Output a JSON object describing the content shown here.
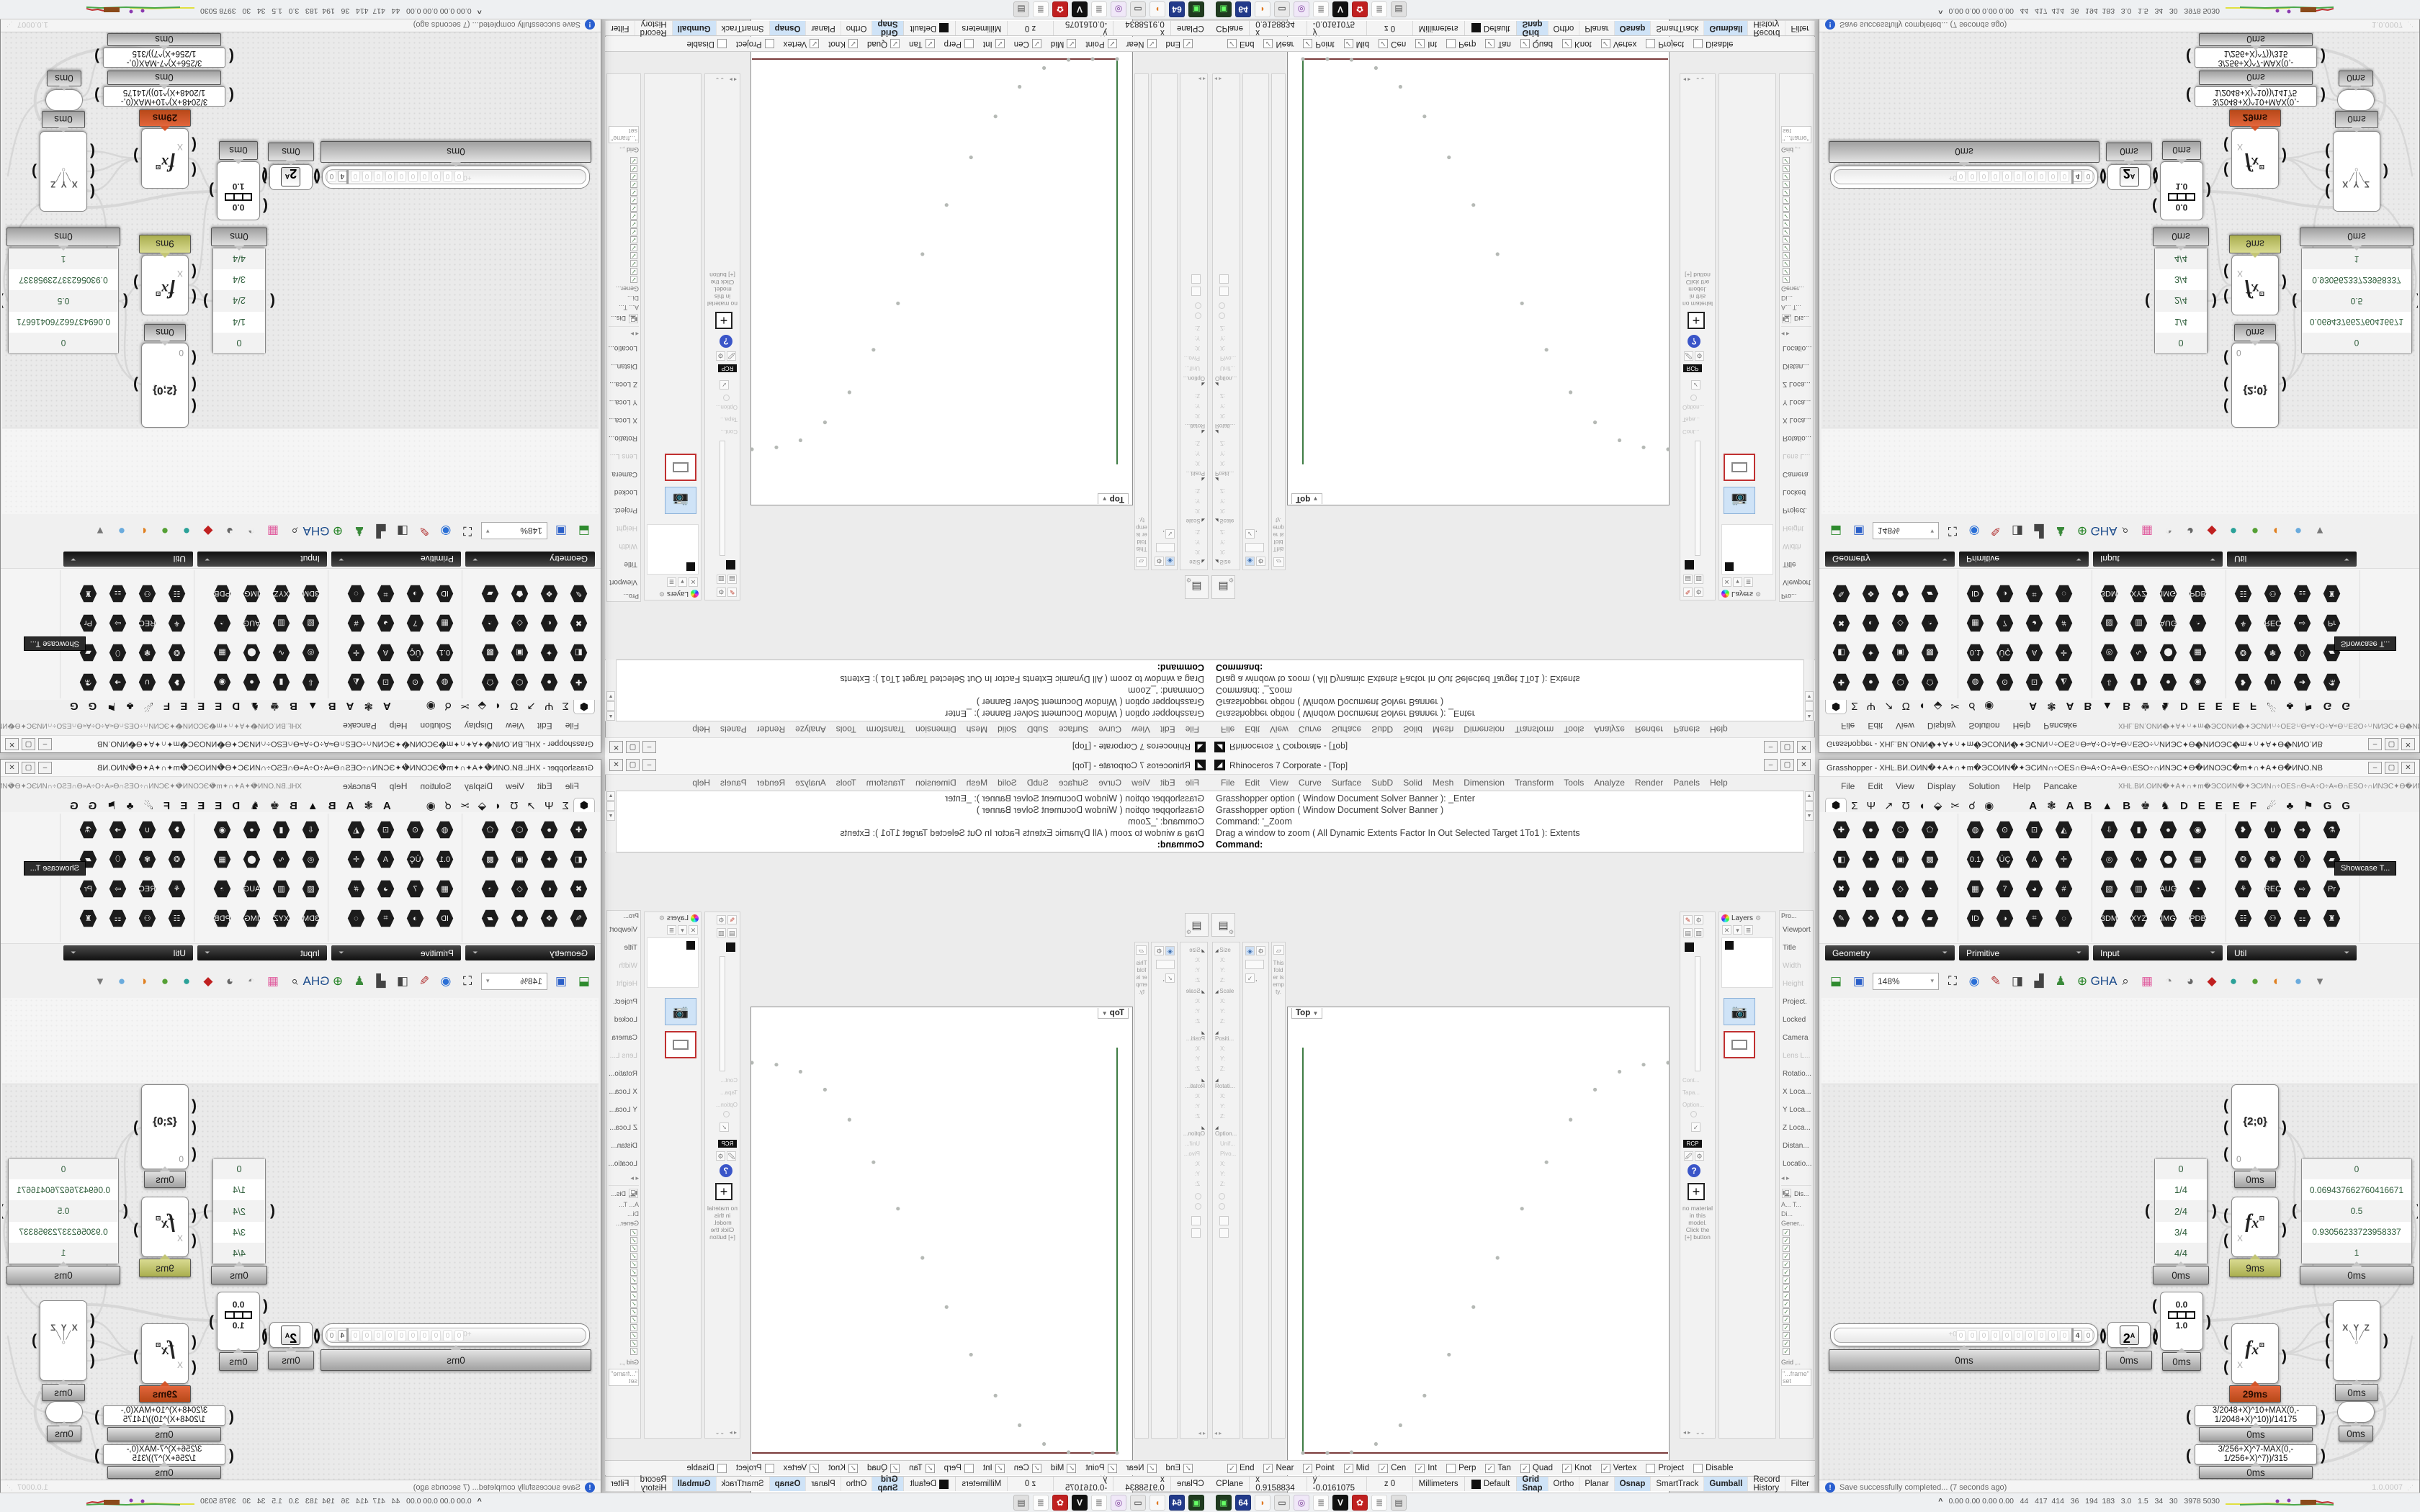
{
  "layout_note": "Single Rhino+Grasshopper screenshot tiled 2x2 with mirror transforms (BR normal, BL flipped-X, TR flipped-Y, TL rotated 180)",
  "rhino": {
    "title": "Rhinoceros 7 Corporate - [Top]",
    "window_buttons": [
      "‒",
      "▢",
      "✕"
    ],
    "menu": [
      "File",
      "Edit",
      "View",
      "Curve",
      "Surface",
      "SubD",
      "Solid",
      "Mesh",
      "Dimension",
      "Transform",
      "Tools",
      "Analyze",
      "Render",
      "Panels",
      "Help"
    ],
    "command_lines": [
      "Grasshopper option ( Window  Document  Solver  Banner ): _Enter",
      "Grasshopper option ( Window  Document  Solver  Banner )",
      "Command: '_Zoom",
      "Drag a window to zoom ( All  Dynamic  Extents  Factor  In  Out  Selected  Target  1To1 ):  Extents"
    ],
    "command_prompt": "Command:",
    "toolbar_buttons": [
      {
        "g": "✛",
        "name": "compass"
      },
      {
        "g": "⚑",
        "name": "flag"
      },
      {
        "g": "▤",
        "name": "folder"
      }
    ],
    "viewport": {
      "label": "Top",
      "chip_arrow": "▼",
      "tabs": [
        {
          "t": "Top",
          "on": true
        },
        {
          "t": "Top"
        },
        {
          "t": "Perspective"
        },
        {
          "t": "Right"
        },
        {
          "t": "✛"
        }
      ],
      "y_label": "y",
      "x_label": "x"
    },
    "left_panels": {
      "box_sections": [
        {
          "h": "Size",
          "f": [
            "X:",
            "Y:",
            "Z:"
          ]
        },
        {
          "h": "Scale",
          "f": [
            "X:",
            "Y:",
            "Z:"
          ]
        },
        {
          "h": "Positi...",
          "f": [
            "X:",
            "Y:",
            "Z:"
          ]
        },
        {
          "h": "Rotati...",
          "f": [
            "X:",
            "Y:",
            "Z:"
          ]
        },
        {
          "h": "Option...",
          "f": [
            "Unif...",
            "Pivo...",
            "X:",
            "Y:",
            "Z:"
          ]
        }
      ],
      "folder_note": "This folder is empty."
    },
    "right_panels": {
      "layers_label": "Layers",
      "props_label": "Pro...",
      "rcp_badge": "RCP",
      "material_note": "no material in this model. Click the [+] button",
      "faint_labels": [
        "Cont...",
        "Tapa...",
        "Option..."
      ],
      "props_items": [
        {
          "t": "Viewport"
        },
        {
          "t": "Title"
        },
        {
          "t": "Width",
          "dim": true
        },
        {
          "t": "Height",
          "dim": true
        },
        {
          "t": "Project."
        },
        {
          "t": "Locked"
        },
        {
          "t": "Camera"
        },
        {
          "t": "Lens L...",
          "dim": true
        },
        {
          "t": "Rotatio..."
        },
        {
          "t": "X Loca..."
        },
        {
          "t": "Y Loca..."
        },
        {
          "t": "Z Loca..."
        },
        {
          "t": "Distan..."
        },
        {
          "t": "Locatio..."
        }
      ],
      "display_label": "Dis...",
      "display_rows": [
        "A...  T...",
        "Di...",
        "Gener..."
      ],
      "display_checks": [
        "✓",
        "✓",
        "✓",
        "✓",
        "✓",
        "✓",
        "✓",
        "✓",
        "✓",
        "✓",
        "✓",
        "✓",
        "✓",
        "✓",
        "✓",
        "✓"
      ],
      "grid_label": "Grid ,..",
      "frame_note": "\"...frame\" set"
    },
    "osnap": [
      {
        "label": "End",
        "on": true
      },
      {
        "label": "Near",
        "on": true
      },
      {
        "label": "Point",
        "on": true
      },
      {
        "label": "Mid",
        "on": true
      },
      {
        "label": "Cen",
        "on": true
      },
      {
        "label": "Int",
        "on": true
      },
      {
        "label": "Perp"
      },
      {
        "label": "Tan",
        "on": true
      },
      {
        "label": "Quad",
        "on": true
      },
      {
        "label": "Knot",
        "on": true
      },
      {
        "label": "Vertex",
        "on": true
      },
      {
        "label": "Project"
      },
      {
        "label": "Disable"
      }
    ],
    "status": {
      "cells": [
        "CPlane",
        "x 0.9158834",
        "y -0.0161075",
        "z 0",
        "Millimeters",
        "Default"
      ],
      "toggles": [
        {
          "label": "Grid Snap",
          "active": true
        },
        {
          "label": "Ortho"
        },
        {
          "label": "Planar"
        },
        {
          "label": "Osnap",
          "active": true
        },
        {
          "label": "SmartTrack"
        },
        {
          "label": "Gumball",
          "active": true
        },
        {
          "label": "Record History"
        },
        {
          "label": "Filter"
        }
      ]
    }
  },
  "gh": {
    "doc_name": "XHĿ.ВИ.ОИN�✦А✦∩✦m�ЭСОИN�✦ЭСИN∩÷ОЕЅ∩Ѳ≈А÷О÷А≈Ѳ∩ЕЅО÷∩ИNЭС✦Ѳ�ИNОЭС�m✦∩✦А✦Ѳ�ИNО.NB",
    "title_prefix": "Grasshopper - ",
    "window_buttons": [
      "‒",
      "▢",
      "✕"
    ],
    "menu": [
      "File",
      "Edit",
      "View",
      "Display",
      "Solution",
      "Help",
      "Pancake"
    ],
    "tab_glyphs": [
      "Σ",
      "Ψ",
      "↗",
      "Ʊ",
      "◖",
      "⬙",
      "✂",
      "☌",
      "◉"
    ],
    "tab_selected_glyph": "⬢",
    "tab_letters": [
      "A",
      "❃",
      "A",
      "B",
      "▲",
      "B",
      "♚",
      "♞",
      "D",
      "E",
      "E",
      "E",
      "F",
      "☄",
      "♣",
      "⚑",
      "G",
      "G"
    ],
    "palette_groups": [
      {
        "label": "Geometry",
        "x": 8,
        "w": 182,
        "icons": [
          {
            "g": "✚"
          },
          {
            "g": "●"
          },
          {
            "g": "⬡"
          },
          {
            "g": "⬠"
          },
          {
            "g": "◧"
          },
          {
            "g": "✦"
          },
          {
            "g": "▣"
          },
          {
            "g": "▩"
          },
          {
            "g": "✖"
          },
          {
            "g": "◐"
          },
          {
            "g": "◇"
          },
          {
            "g": "◔"
          },
          {
            "g": "✎"
          },
          {
            "g": "❖"
          },
          {
            "g": "⬟"
          },
          {
            "g": "▰"
          }
        ]
      },
      {
        "label": "Primitive",
        "x": 194,
        "w": 182,
        "icons": [
          {
            "g": "◍"
          },
          {
            "g": "⊙"
          },
          {
            "g": "⊡"
          },
          {
            "g": "◭"
          },
          {
            "g": "0.1"
          },
          {
            "g": "ÜÇ"
          },
          {
            "g": "A"
          },
          {
            "g": "✛"
          },
          {
            "g": "▦"
          },
          {
            "g": "7"
          },
          {
            "g": "◕"
          },
          {
            "g": "#"
          },
          {
            "g": "ID"
          },
          {
            "g": "◑"
          },
          {
            "g": "⌗"
          },
          {
            "g": "◌"
          }
        ]
      },
      {
        "label": "Input",
        "x": 380,
        "w": 182,
        "icons": [
          {
            "g": "⇩"
          },
          {
            "g": "▮"
          },
          {
            "g": "●",
            "bg": "#e255a1",
            "fg": "#ffffff"
          },
          {
            "g": "◉",
            "bg": "#f3eef6",
            "fg": "#b08cc0"
          },
          {
            "g": "◎"
          },
          {
            "g": "∿",
            "bg": "#e8c832",
            "fg": "#7a5a10"
          },
          {
            "g": "⬤"
          },
          {
            "g": "▦",
            "bg": "#78c84e",
            "fg": "#2f5f1f"
          },
          {
            "g": "▧",
            "bg": "#f6f6f6",
            "fg": "#333333"
          },
          {
            "g": "▥",
            "bg": "#cc4444",
            "fg": "#ffffff"
          },
          {
            "g": "AUG",
            "bg": "#111111",
            "fg": "#ffffff"
          },
          {
            "g": "◔",
            "bg": "#111111",
            "fg": "#eeeeee"
          },
          {
            "g": "3DM",
            "bg": "#f8f8f8",
            "fg": "#111111"
          },
          {
            "g": "XYZ",
            "bg": "#f8f8f8",
            "fg": "#111111"
          },
          {
            "g": "IMG",
            "bg": "#f8f8f8",
            "fg": "#111111"
          },
          {
            "g": "PDB",
            "bg": "#f8f8f8",
            "fg": "#111111"
          }
        ]
      },
      {
        "label": "Util",
        "x": 566,
        "w": 182,
        "icons": [
          {
            "g": "❥",
            "fg": "#c42020"
          },
          {
            "g": "∪",
            "bg": "#222222",
            "fg": "#dddddd"
          },
          {
            "g": "➜",
            "fg": "#666666"
          },
          {
            "g": "⚗",
            "bg": "#efe6f2",
            "fg": "#c05090"
          },
          {
            "g": "❂",
            "fg": "#8844aa"
          },
          {
            "g": "✾",
            "bg": "#2a2a2a",
            "fg": "#ffd0e8"
          },
          {
            "g": "⬯",
            "bg": "#e8e8e8",
            "fg": "#333333"
          },
          {
            "g": "▰",
            "bg": "#5a2a78",
            "fg": "#ffffff"
          },
          {
            "g": "⚘",
            "fg": "#c06090"
          },
          {
            "g": "REC",
            "bg": "#d9d9d9",
            "fg": "#c04a10"
          },
          {
            "g": "⇨",
            "fg": "#888888"
          },
          {
            "g": "Pr",
            "bg": "#3a2a5a",
            "fg": "#d8c8f8"
          },
          {
            "g": "☷",
            "bg": "#222222",
            "fg": "#eeeeee"
          },
          {
            "g": "⚇",
            "fg": "#3a6fd8"
          },
          {
            "g": "⚏",
            "bg": "#111111",
            "fg": "#ffffff"
          },
          {
            "g": "♜",
            "fg": "#444444"
          }
        ]
      }
    ],
    "tooltip": "Showcase T...",
    "toolbar": {
      "open_icon": "⬓",
      "save_icon": "▣",
      "zoom": "148%",
      "icons": [
        {
          "g": "⛶",
          "fg": "#222222"
        },
        {
          "g": "◉",
          "fg": "#2a6fd6"
        },
        {
          "g": "✎",
          "fg": "#b03030"
        },
        {
          "g": "◨",
          "fg": "#444444"
        },
        {
          "g": "▟",
          "fg": "#444444"
        },
        {
          "g": "♟",
          "fg": "#3a8a3a"
        },
        {
          "g": "⊕",
          "fg": "#208020"
        },
        {
          "g": "GHA",
          "fg": "#1a4a8a"
        },
        {
          "g": "⌕",
          "fg": "#333333"
        },
        {
          "g": "▦",
          "fg": "#e060a0"
        },
        {
          "g": "◔",
          "fg": "#888888"
        },
        {
          "g": "◕",
          "fg": "#666666"
        },
        {
          "g": "◆",
          "fg": "#c02020"
        },
        {
          "g": "●",
          "fg": "#2aa198"
        },
        {
          "g": "●",
          "fg": "#55a035"
        },
        {
          "g": "◐",
          "fg": "#e08020"
        },
        {
          "g": "●",
          "fg": "#6aabdd"
        },
        {
          "g": "▾",
          "fg": "#777777"
        }
      ]
    },
    "nodes": {
      "slider": {
        "badge": "0ms",
        "cells": [
          "0",
          "0",
          "0",
          "0",
          "0",
          "0",
          "0",
          "0",
          "0",
          "0"
        ],
        "value": "4",
        "tail": "0",
        "marker": "+0"
      },
      "pow": {
        "base": "2",
        "sup": "A",
        "badge": "0ms"
      },
      "gradient": {
        "top": "0.0",
        "bottom": "1.0",
        "badge": "0ms"
      },
      "path": {
        "label": "{2;0}",
        "input": "0",
        "badge": "0ms"
      },
      "frac_panel": {
        "rows": [
          "0",
          "1/4",
          "2/4",
          "3/4",
          "4/4"
        ],
        "badge": "0ms"
      },
      "fx1": {
        "input": "X",
        "badge": "9ms"
      },
      "values_panel": {
        "rows": [
          "0",
          "0.069437662760416671",
          "0.5",
          "0.93056233723958337",
          "1"
        ],
        "badge": "0ms"
      },
      "fx2": {
        "input": "X",
        "badge": "29ms"
      },
      "xyz": {
        "label": "X Y Z",
        "badge": "0ms"
      },
      "expr1": {
        "text": "3/2048+X)^10+MAX(0,- 1/2048+X)^10))/14175",
        "badge": "0ms"
      },
      "expr2": {
        "text": "3/256+X)^7-MAX(0,- 1/256+X)^7))/315",
        "badge": "0ms"
      },
      "capsule": {
        "badge": "0ms"
      }
    },
    "status": {
      "message": "Save successfully completed... (7 seconds ago)",
      "version": "1.0.0007"
    }
  },
  "taskbar": {
    "icons": [
      {
        "g": "▣",
        "bg": "#1f3b1f",
        "fg": "#66ff66"
      },
      {
        "g": "64",
        "bg": "#223a8a",
        "fg": "#ffffff"
      },
      {
        "g": "◗",
        "bg": "#f8f8f8",
        "fg": "#e07820"
      },
      {
        "g": "▭",
        "bg": "#e8e8e8",
        "fg": "#333333"
      },
      {
        "g": "◎",
        "bg": "#f0e8f8",
        "fg": "#7a3a9a"
      },
      {
        "g": "≣",
        "bg": "#fdfdfd",
        "fg": "#888888"
      },
      {
        "g": "V",
        "bg": "#111111",
        "fg": "#ffffff"
      },
      {
        "g": "✿",
        "bg": "#c02020",
        "fg": "#ffffff"
      },
      {
        "g": "≣",
        "bg": "#fdfdfd",
        "fg": "#888888"
      },
      {
        "g": "▤",
        "bg": "#e0e0e0",
        "fg": "#555555"
      }
    ],
    "monitor_caret": "^",
    "monitor_values": "0.00 0.00 0.00 0.00   44   417  414   36   194  183   3.0   1.5   34   30   3978 5030"
  },
  "chart_data": {
    "type": "scatter",
    "title": "Rhino Top viewport: sampled smooth-step point curve",
    "xlabel": "x",
    "ylabel": "y",
    "xlim": [
      0,
      1
    ],
    "ylim": [
      0,
      1
    ],
    "grid": false,
    "points": [
      {
        "x": 0.0,
        "y": 0.0
      },
      {
        "x": 0.067,
        "y": 0.0
      },
      {
        "x": 0.133,
        "y": 0.002
      },
      {
        "x": 0.2,
        "y": 0.023
      },
      {
        "x": 0.267,
        "y": 0.071
      },
      {
        "x": 0.333,
        "y": 0.147
      },
      {
        "x": 0.4,
        "y": 0.252
      },
      {
        "x": 0.467,
        "y": 0.374
      },
      {
        "x": 0.533,
        "y": 0.5
      },
      {
        "x": 0.6,
        "y": 0.626
      },
      {
        "x": 0.667,
        "y": 0.745
      },
      {
        "x": 0.733,
        "y": 0.854
      },
      {
        "x": 0.8,
        "y": 0.931
      },
      {
        "x": 0.867,
        "y": 0.977
      },
      {
        "x": 0.933,
        "y": 0.995
      },
      {
        "x": 1.0,
        "y": 1.0
      }
    ],
    "series_values_panel": [
      0,
      0.06943766276041667,
      0.5,
      0.9305623372395834,
      1
    ],
    "series_t_panel": [
      "0",
      "1/4",
      "2/4",
      "3/4",
      "4/4"
    ]
  }
}
